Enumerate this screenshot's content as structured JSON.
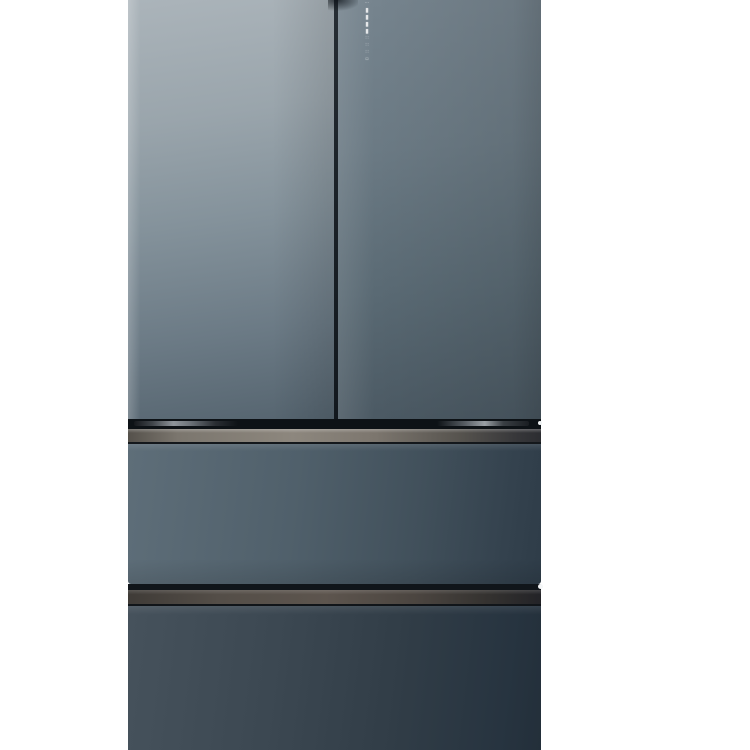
{
  "scene": {
    "description": "Product photograph of a four-door French-door refrigerator with a slate blue-gray glass finish, shown on a plain white background, cropped at the top and bottom edges",
    "background_color": "#ffffff"
  },
  "refrigerator": {
    "style": "french-door, two upper doors and two full-width lower freezer drawers",
    "finish": "matte slate blue-gray glass",
    "colors": {
      "left_door_gradient": [
        "#abb4ba",
        "#55646f"
      ],
      "right_door_gradient": [
        "#76848e",
        "#4a5862"
      ],
      "middle_drawer_gradient": [
        "#5e6e79",
        "#2e3c48"
      ],
      "bottom_drawer_gradient": [
        "#46525c",
        "#232f3a"
      ],
      "upper_handle_strip": "#8d877e",
      "lower_handle_strip": "#5d554e",
      "hinge_band": "#0d1216",
      "door_seam": "#1b2228",
      "display_glyphs": "#ffffff"
    },
    "display": {
      "type": "vertical-touch-display",
      "location": "top of right door, beside center seam",
      "segment_count": 9,
      "segments": [
        {
          "glyph": "⋯"
        },
        {
          "glyph": "▮"
        },
        {
          "glyph": "▮"
        },
        {
          "glyph": "▮"
        },
        {
          "glyph": "▮"
        },
        {
          "glyph": "∷"
        },
        {
          "glyph": "∷"
        },
        {
          "glyph": "∷"
        },
        {
          "glyph": "▫"
        }
      ]
    }
  }
}
